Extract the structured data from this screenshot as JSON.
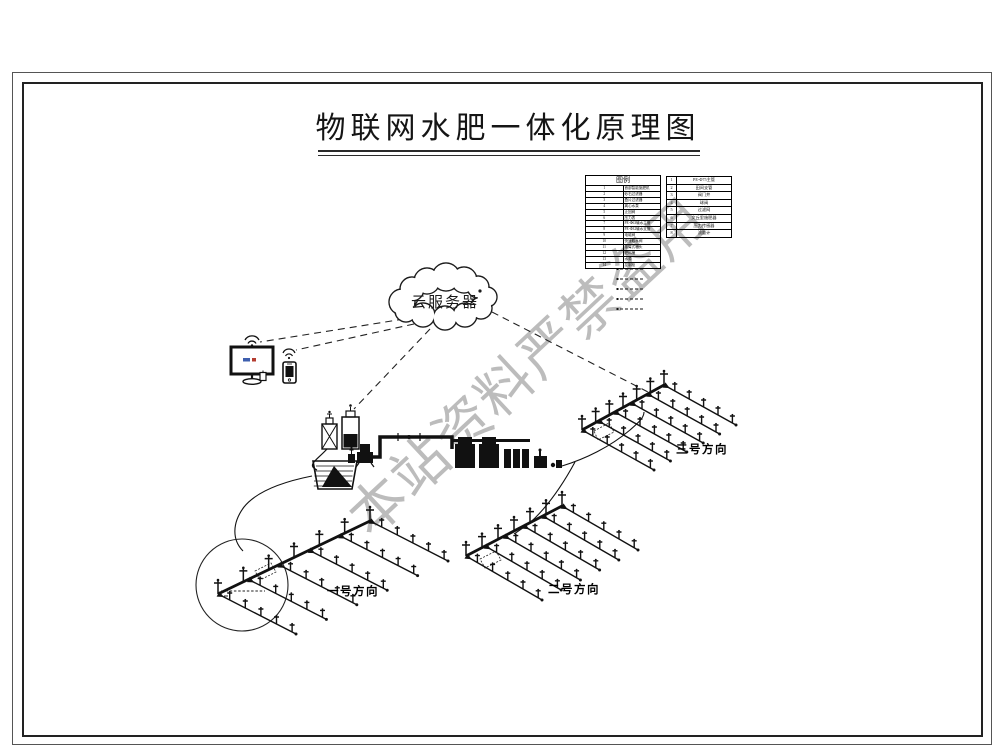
{
  "header": {
    "title": "物联网水肥一体化原理图"
  },
  "watermark": {
    "text": "本站资料严禁盗用",
    "color": "#bcbcbc"
  },
  "cloud": {
    "label": "云服务器"
  },
  "legend": {
    "left": {
      "header": "图例",
      "rows": [
        {
          "no": "1",
          "label": "首部智能施肥机"
        },
        {
          "no": "2",
          "label": "砂石过滤器"
        },
        {
          "no": "3",
          "label": "叠片过滤器"
        },
        {
          "no": "4",
          "label": "离心水泵"
        },
        {
          "no": "5",
          "label": "止回阀"
        },
        {
          "no": "6",
          "label": "压力表"
        },
        {
          "no": "7",
          "label": "PE-Φ63输水主管"
        },
        {
          "no": "8",
          "label": "PE-Φ32输水支管"
        },
        {
          "no": "9",
          "label": "电磁阀"
        },
        {
          "no": "10",
          "label": "快速取水阀"
        },
        {
          "no": "11",
          "label": "摇臂式喷头"
        },
        {
          "no": "12",
          "label": "肥料桶"
        },
        {
          "no": "13",
          "label": "水源"
        },
        {
          "no": "14",
          "label": "控制柜"
        }
      ]
    },
    "right": {
      "rows": [
        {
          "no": "1",
          "label": "PE-Φ75主管"
        },
        {
          "no": "2",
          "label": "田间支管"
        },
        {
          "no": "3",
          "label": "阀门井"
        },
        {
          "no": "4",
          "label": "球阀"
        },
        {
          "no": "5",
          "label": "过滤网"
        },
        {
          "no": "6",
          "label": "文丘里施肥器"
        },
        {
          "no": "7",
          "label": "压力传感器"
        },
        {
          "no": "8",
          "label": "流量计"
        }
      ]
    }
  },
  "fields": [
    {
      "label": "一号方向"
    },
    {
      "label": "二号方向"
    },
    {
      "label": "三号方向"
    }
  ],
  "colors": {
    "line": "#111111",
    "watermark": "#bcbcbc",
    "background": "#ffffff"
  }
}
